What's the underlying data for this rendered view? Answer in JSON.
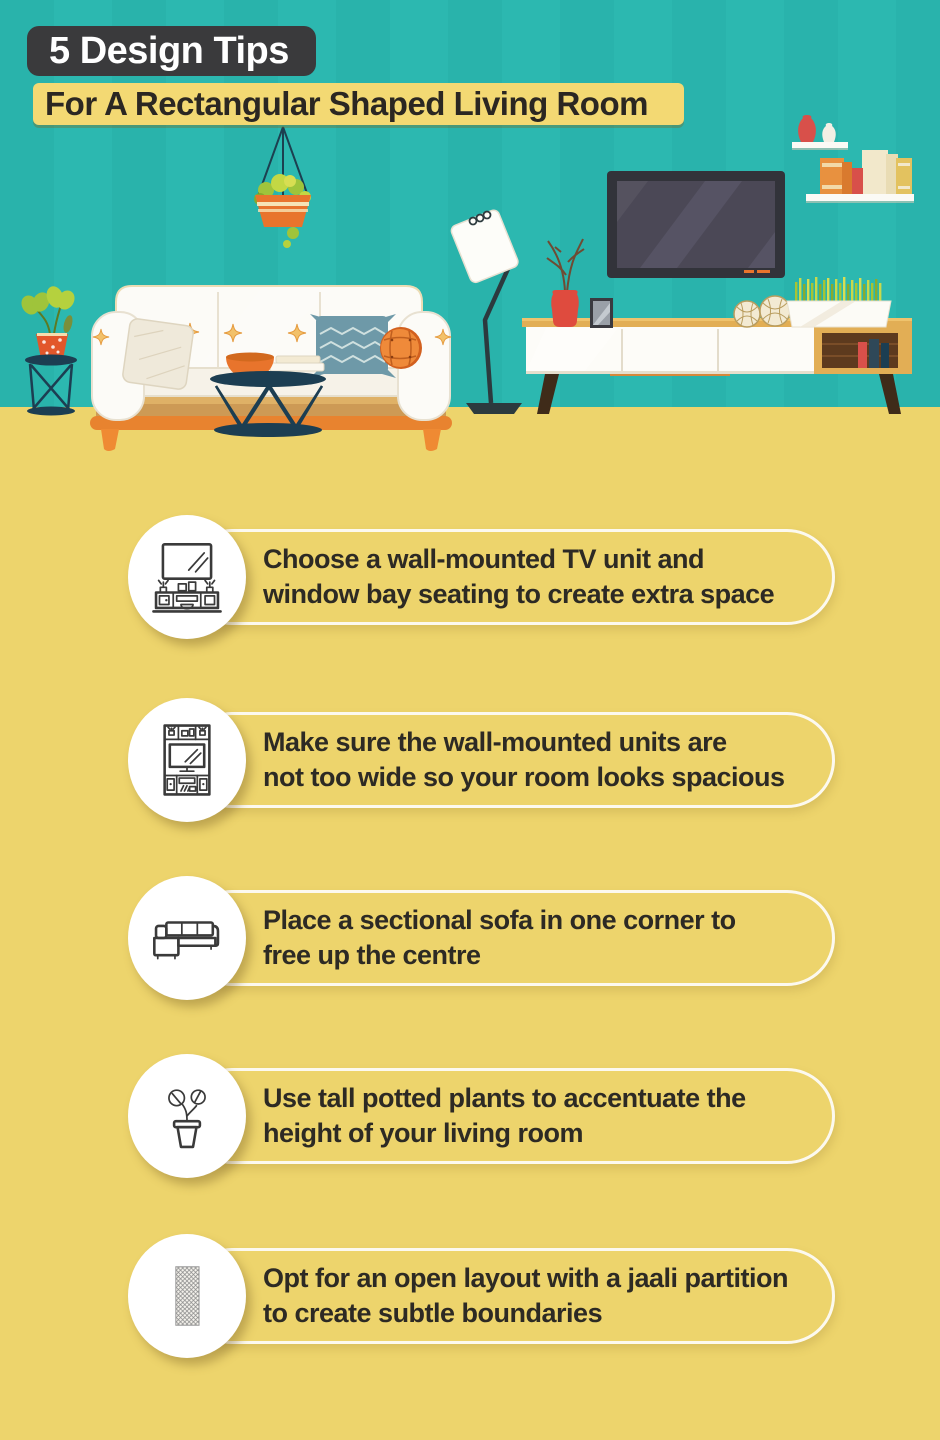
{
  "header": {
    "title": "5 Design Tips",
    "subtitle": "For A Rectangular Shaped Living Room"
  },
  "tips": [
    {
      "icon": "wall-mounted-tv-unit-icon",
      "line1": "Choose a wall-mounted TV unit and",
      "line2": "window bay seating to create extra space"
    },
    {
      "icon": "wall-unit-icon",
      "line1": "Make sure the wall-mounted units are",
      "line2": "not too wide so your room looks spacious"
    },
    {
      "icon": "sectional-sofa-icon",
      "line1": "Place a sectional sofa in one corner to",
      "line2": "free up the centre"
    },
    {
      "icon": "potted-plant-icon",
      "line1": "Use tall potted plants to accentuate the",
      "line2": "height of your living room"
    },
    {
      "icon": "jaali-partition-icon",
      "line1": "Opt for an open layout with a jaali partition",
      "line2": "to create subtle boundaries"
    }
  ],
  "colors": {
    "wall_teal": "#2cb8b0",
    "floor_yellow": "#edd46c",
    "title_bg_dark": "#3a3a3c",
    "subtitle_bg_yellow": "#f3d973",
    "text_dark": "#2d2a24",
    "accent_orange": "#e8772e",
    "navy": "#1c3e52",
    "wood_tan": "#e2ae55"
  },
  "scene": {
    "description": "flat-style living room illustration",
    "items": [
      "hanging-planter",
      "side-table-with-plant",
      "sofa-with-cushions",
      "coffee-table",
      "floor-lamp",
      "wall-mounted-tv",
      "wall-shelf-vases",
      "wall-shelf-books",
      "tv-console",
      "red-vase-twigs",
      "photo-frame",
      "wicker-balls",
      "grass-planter"
    ]
  }
}
